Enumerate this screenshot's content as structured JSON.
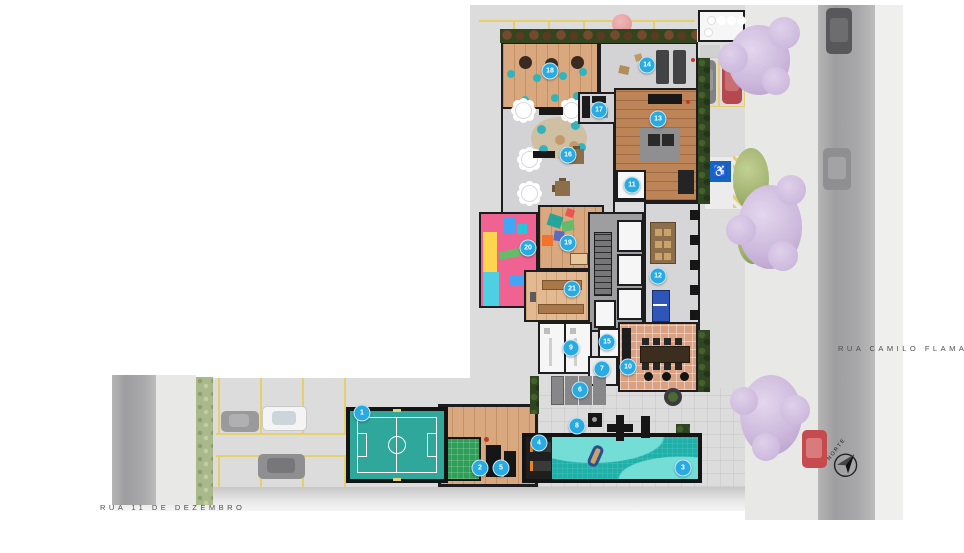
{
  "title": "implantacao-terreo",
  "streets": {
    "left": "RUA 11 DE DEZEMBRO",
    "right": "RUA CAMILO FLAMARION"
  },
  "compass": {
    "label": "NORTE"
  },
  "colors": {
    "marker_accent": "#29abe2",
    "pool_water": "#1fb1a9",
    "pool_wave": "#74ded6",
    "court_green": "#2fa79a",
    "small_court_green": "#2f9e58",
    "paving_gray": "#dcdcdd",
    "wood_deck": "#d9a87f",
    "lilac_tree": "#cdb9dc",
    "accessible_sign_blue": "#1565c0"
  },
  "accessible_parking": {
    "symbol": "♿"
  },
  "markers": [
    {
      "n": "1",
      "x": 362,
      "y": 413
    },
    {
      "n": "2",
      "x": 480,
      "y": 468
    },
    {
      "n": "3",
      "x": 683,
      "y": 468
    },
    {
      "n": "4",
      "x": 539,
      "y": 443
    },
    {
      "n": "5",
      "x": 501,
      "y": 468
    },
    {
      "n": "6",
      "x": 580,
      "y": 390
    },
    {
      "n": "7",
      "x": 602,
      "y": 369
    },
    {
      "n": "8",
      "x": 577,
      "y": 426
    },
    {
      "n": "9",
      "x": 571,
      "y": 348
    },
    {
      "n": "10",
      "x": 628,
      "y": 367
    },
    {
      "n": "11",
      "x": 632,
      "y": 185
    },
    {
      "n": "12",
      "x": 658,
      "y": 276
    },
    {
      "n": "13",
      "x": 658,
      "y": 119
    },
    {
      "n": "14",
      "x": 647,
      "y": 65
    },
    {
      "n": "15",
      "x": 607,
      "y": 342
    },
    {
      "n": "16",
      "x": 568,
      "y": 155
    },
    {
      "n": "17",
      "x": 599,
      "y": 110
    },
    {
      "n": "18",
      "x": 550,
      "y": 71
    },
    {
      "n": "19",
      "x": 568,
      "y": 243
    },
    {
      "n": "20",
      "x": 528,
      "y": 248
    },
    {
      "n": "21",
      "x": 572,
      "y": 289
    }
  ]
}
